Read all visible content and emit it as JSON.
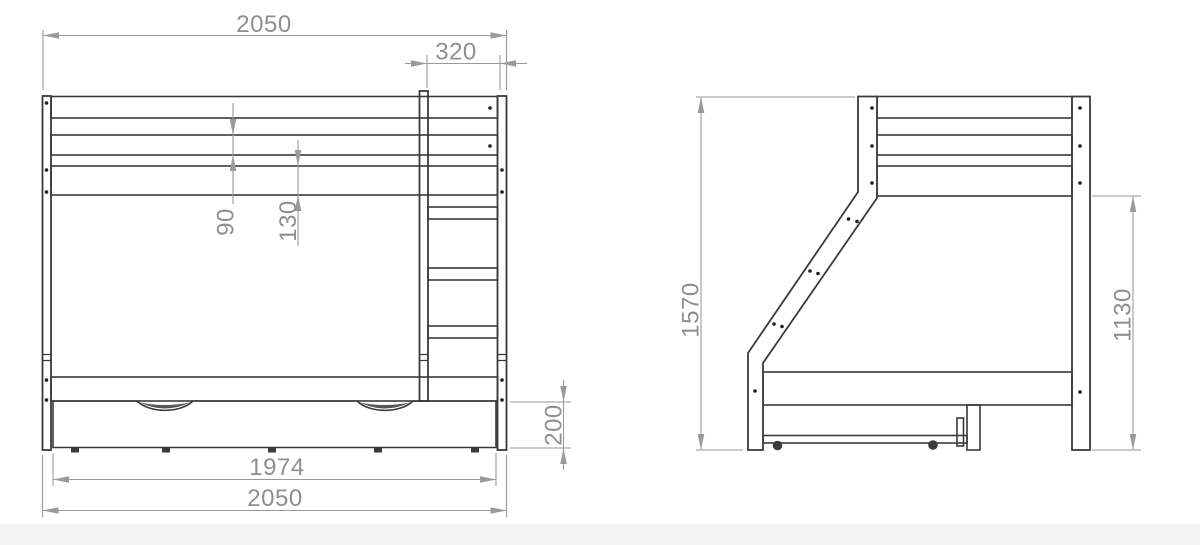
{
  "drawing": {
    "title": "bunk-bed-technical-drawing",
    "dims": {
      "front_width_top": "2050",
      "ladder_width": "320",
      "guard_board_height": "90",
      "frame_board_height": "130",
      "drawer_height": "200",
      "drawer_width": "1974",
      "front_width_bottom": "2050",
      "side_total_height": "1570",
      "side_post_height": "1130"
    },
    "colors": {
      "line": "#3a3a3a",
      "dim": "#9a9a9a",
      "text": "#8f8f8f",
      "background": "#ffffff"
    }
  }
}
